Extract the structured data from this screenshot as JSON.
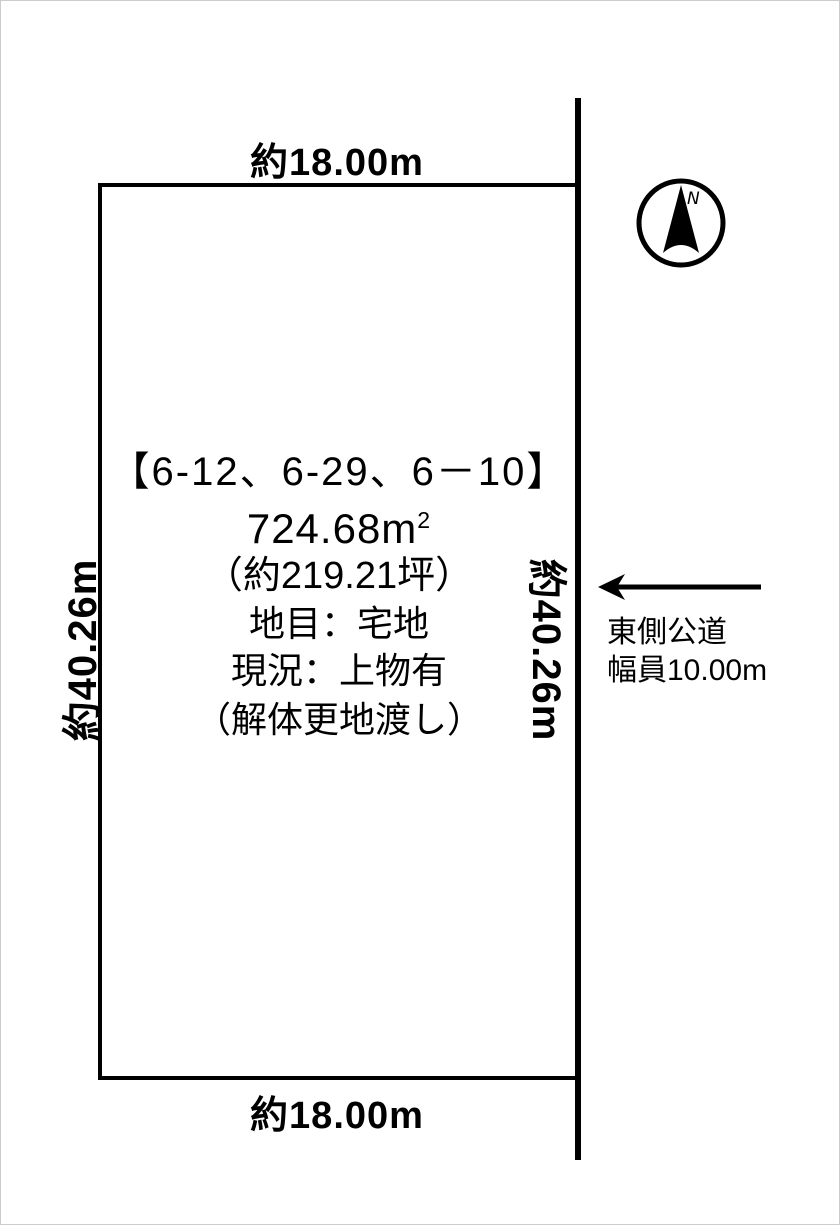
{
  "diagram": {
    "dimensions": {
      "top": "約18.00m",
      "bottom": "約18.00m",
      "left": "約40.26m",
      "right": "約40.26m"
    },
    "parcel": {
      "lot_numbers": "【6-12、6-29、6－10】",
      "area_value": "724.68m",
      "area_exponent": "2",
      "area_tsubo": "（約219.21坪）",
      "land_category": "地目：宅地",
      "current_status": "現況：上物有",
      "delivery_note": "（解体更地渡し）"
    },
    "road": {
      "line1": "東側公道",
      "line2": "幅員10.00m"
    },
    "compass": {
      "label": "N"
    },
    "colors": {
      "line": "#000000",
      "background": "#ffffff",
      "page_border": "#cccccc"
    }
  }
}
